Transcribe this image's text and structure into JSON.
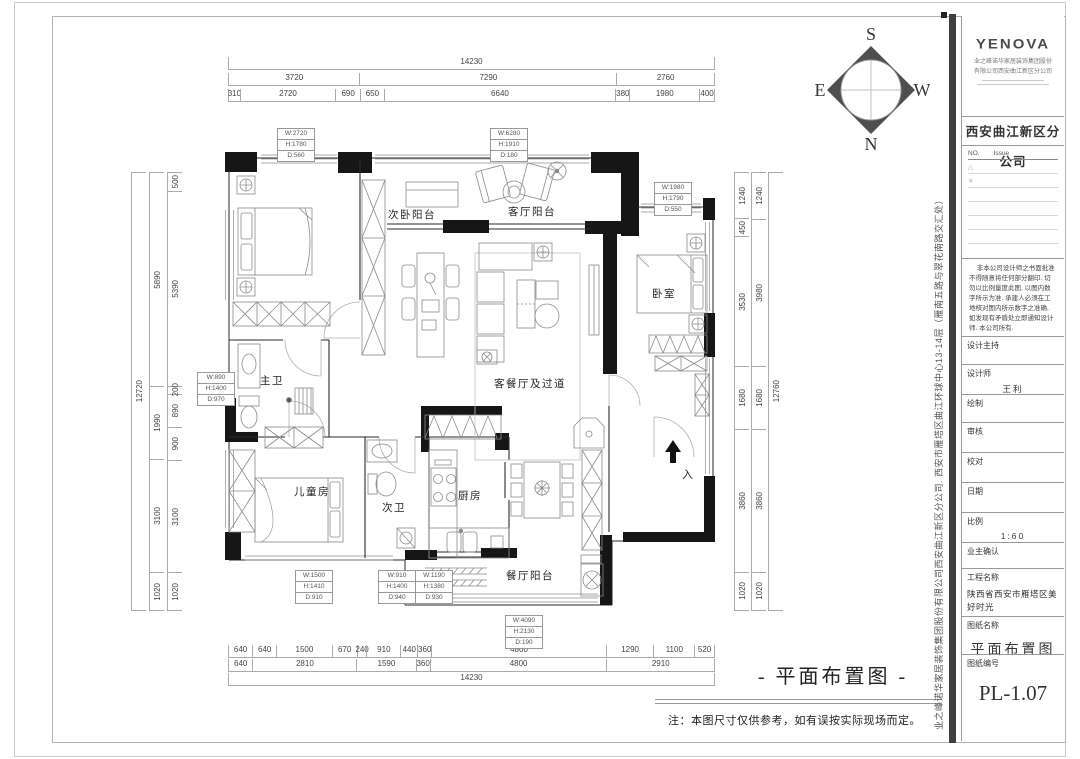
{
  "page": {
    "drawing_title": "- 平面布置图 -",
    "note": "注：本图尺寸仅供参考，如有误按实际现场而定。"
  },
  "compass": {
    "n": "N",
    "s": "S",
    "e": "E",
    "w": "W"
  },
  "rooms": {
    "secondary_bedroom_balcony": "次卧阳台",
    "living_balcony": "客厅阳台",
    "bedroom": "卧室",
    "living_dining": "客餐厅及过道",
    "master_bath": "主卫",
    "kids_room": "儿童房",
    "second_bath": "次卫",
    "kitchen": "厨房",
    "dining_balcony": "餐厅阳台",
    "entrance": "入"
  },
  "window_tags": [
    {
      "w": "W:2720",
      "h": "H:1780",
      "d": "D:560"
    },
    {
      "w": "W:6280",
      "h": "H:1910",
      "d": "D:180"
    },
    {
      "w": "W:1980",
      "h": "H:1790",
      "d": "D:550"
    },
    {
      "w": "W:890",
      "h": "H:1400",
      "d": "D:970"
    },
    {
      "w": "W:1500",
      "h": "H:1410",
      "d": "D:910"
    },
    {
      "w": "W:910",
      "h": "H:1400",
      "d": "D:940"
    },
    {
      "w": "W:1190",
      "h": "H:1380",
      "d": "D:930"
    },
    {
      "w": "W:4090",
      "h": "H:2130",
      "d": "D:190"
    }
  ],
  "dimensions": {
    "top": {
      "total": [
        "14230"
      ],
      "row2": [
        "3720",
        "7290",
        "2760"
      ],
      "row3": [
        "310",
        "2720",
        "690",
        "650",
        "6640",
        "380",
        "1980",
        "400"
      ]
    },
    "bottom": {
      "row1": [
        "640",
        "640",
        "1500",
        "670",
        "240",
        "910",
        "440",
        "360",
        "4800",
        "1290",
        "1100",
        "520"
      ],
      "row2": [
        "640",
        "2810",
        "1590",
        "360",
        "4800",
        "2910"
      ],
      "total": [
        "14230"
      ]
    },
    "left": {
      "total": [
        "12720"
      ],
      "mid": [
        "5890",
        "1990",
        "3100",
        "1020"
      ],
      "inner": [
        "500",
        "5390",
        "200",
        "890",
        "900",
        "3100",
        "1020"
      ]
    },
    "right": {
      "inner": [
        "1240",
        "450",
        "3530",
        "1680",
        "3860",
        "1020"
      ],
      "mid": [
        "1240",
        "3980",
        "1680",
        "3860",
        "1020"
      ],
      "total": [
        "12760"
      ]
    }
  },
  "title_block": {
    "logo": "YENOVA",
    "company_line1": "业之峰诺华家居装饰集团股份",
    "company_line2": "有限公司西安曲江新区分公司",
    "branch": "西安曲江新区分公司",
    "issue_no": "NO.",
    "issue": "Issue",
    "marks": [
      "△",
      "✕"
    ],
    "notice": "非本公司设计师之书面批准不得随意将任何部分翻印. 切勿以比例量度此图, 以图内数字所示为准. 承建人必须在工地核对图内所示数字之准确, 如发现有矛盾处立即通知设计师. 本公司所有.",
    "fields": [
      {
        "label": "设计主持",
        "value": ""
      },
      {
        "label": "设计师",
        "value": "王利"
      },
      {
        "label": "绘制",
        "value": ""
      },
      {
        "label": "审核",
        "value": ""
      },
      {
        "label": "校对",
        "value": ""
      },
      {
        "label": "日期",
        "value": ""
      },
      {
        "label": "比例",
        "value": "1:60"
      },
      {
        "label": "业主确认",
        "value": ""
      },
      {
        "label": "工程名称",
        "value": "陕西省西安市雁塔区美好时光"
      },
      {
        "label": "图纸名称",
        "value": "平面布置图"
      },
      {
        "label": "图纸编号",
        "value": "PL-1.07"
      }
    ],
    "side_text": "业之峰诺华家居装饰集团股份有限公司西安曲江新区分公司. 西安市雁塔区曲江环球中心13-14层（雁南五路与翠花南路交汇处）"
  }
}
